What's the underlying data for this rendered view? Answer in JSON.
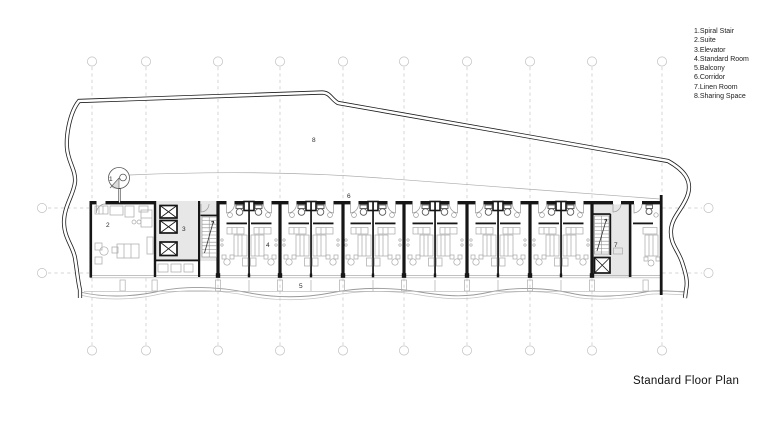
{
  "legend": {
    "items": [
      "1.Spiral Stair",
      "2.Suite",
      "3.Elevator",
      "4.Standard Room",
      "5.Balcony",
      "6.Corridor",
      "7.Linen Room",
      "8.Sharing Space"
    ]
  },
  "title": "Standard Floor Plan",
  "plan": {
    "labels": [
      {
        "id": "spiral-stair",
        "text": "1"
      },
      {
        "id": "suite",
        "text": "2"
      },
      {
        "id": "elevator",
        "text": "3"
      },
      {
        "id": "standard-room",
        "text": "4"
      },
      {
        "id": "balcony",
        "text": "5"
      },
      {
        "id": "corridor",
        "text": "6"
      },
      {
        "id": "linen-room",
        "text": "7"
      },
      {
        "id": "sharing-space",
        "text": "8"
      }
    ]
  },
  "colors": {
    "wall": "#161616",
    "light_line": "#a8a8a8",
    "grid": "#c6c6c6",
    "core_fill": "#e7e7e7"
  }
}
